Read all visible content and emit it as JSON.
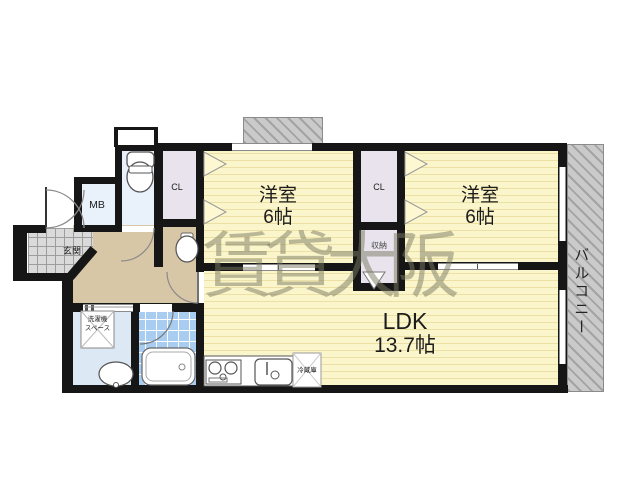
{
  "watermark": "賃貸大阪",
  "rooms": {
    "bedroom_left": {
      "name": "洋室",
      "size": "6帖"
    },
    "bedroom_right": {
      "name": "洋室",
      "size": "6帖"
    },
    "ldk": {
      "name": "LDK",
      "size": "13.7帖"
    },
    "closet_left": {
      "label": "CL"
    },
    "closet_right": {
      "label": "CL"
    },
    "storage": {
      "label": "収納"
    },
    "meter_box": {
      "label": "MB"
    },
    "entrance": {
      "label": "玄関"
    },
    "balcony": {
      "label": "バルコニー"
    },
    "washer_space": {
      "line1": "洗濯機",
      "line2": "スペース"
    },
    "fridge": {
      "label": "冷蔵庫"
    }
  },
  "colors": {
    "room_floor": "#fbf5cb",
    "hallway": "#d8c7a6",
    "closet": "#e8e3ec",
    "wet_area": "#e9f1fa",
    "bath_tile": "#a9cdf1",
    "entrance_tile": "#dadada",
    "balcony": "#cacaca",
    "wall": "#161616",
    "watermark_color": "#7a7a62"
  }
}
